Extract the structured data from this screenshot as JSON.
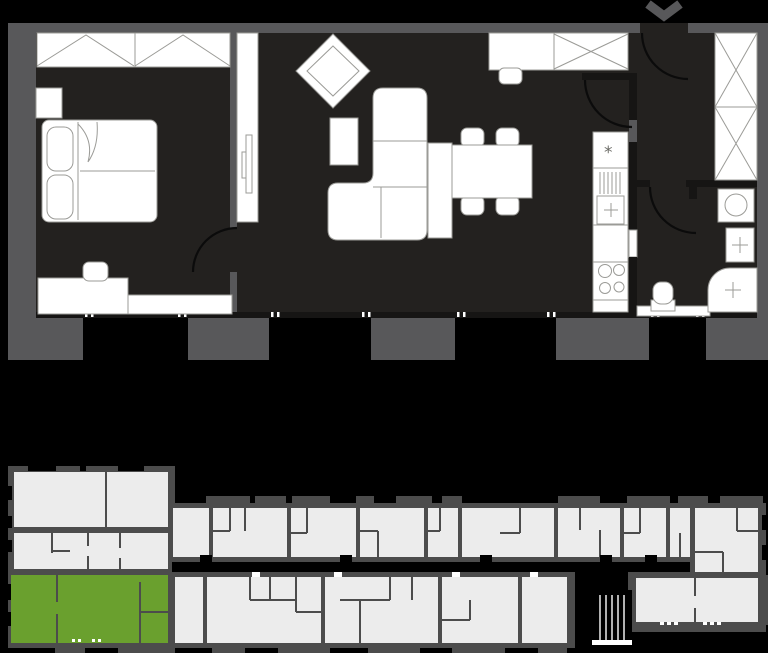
{
  "app": {
    "type": "apartment-floorplan-viewer",
    "visible_text": "none"
  },
  "colors": {
    "plan_floor": "#23211F",
    "plan_outer_wall": "#58585A",
    "plan_inner_wall": "#161514",
    "furniture_fill": "#FFFFFF",
    "furniture_outline": "#9B9B97",
    "door_arc": "#0B0B0B",
    "map_wall": "#4C4C4C",
    "map_unit_fill": "#ECECEC",
    "map_selected_unit": "#6AA02E",
    "chevron": "#58585A"
  },
  "floor_plan": {
    "entrance_marker_icon": "chevron-down",
    "freezer_symbol": "*",
    "rooms": [
      {
        "name": "bedroom",
        "furniture": [
          "wardrobe",
          "niche",
          "double-bed",
          "desk",
          "desk-chair"
        ]
      },
      {
        "name": "living-room",
        "furniture": [
          "tv-wall-unit",
          "tv",
          "armchair",
          "side-table",
          "corner-sofa",
          "sideboard",
          "dining-table",
          "dining-chairs",
          "bar-counter",
          "stool",
          "wall-cabinet"
        ]
      },
      {
        "name": "kitchen",
        "furniture": [
          "fridge-freezer",
          "sink-with-drainer",
          "countertop",
          "cooktop"
        ]
      },
      {
        "name": "entrance-hall",
        "furniture": [
          "wardrobe"
        ]
      },
      {
        "name": "bathroom",
        "furniture": [
          "washing-machine",
          "washbasin",
          "shower",
          "toilet"
        ]
      }
    ],
    "doors": [
      "entrance-door",
      "bedroom-door",
      "living-room-door",
      "bathroom-door",
      "kitchen-door"
    ],
    "window_openings": 4
  },
  "overview_map": {
    "description": "building-floor-overview",
    "highlight_color": "#6AA02E",
    "selected_unit": {
      "position": "bottom-left",
      "highlighted": true
    },
    "areas": [
      "left-wing",
      "top-row-units",
      "corridor",
      "bottom-row-units",
      "stairwell",
      "right-wing"
    ]
  }
}
